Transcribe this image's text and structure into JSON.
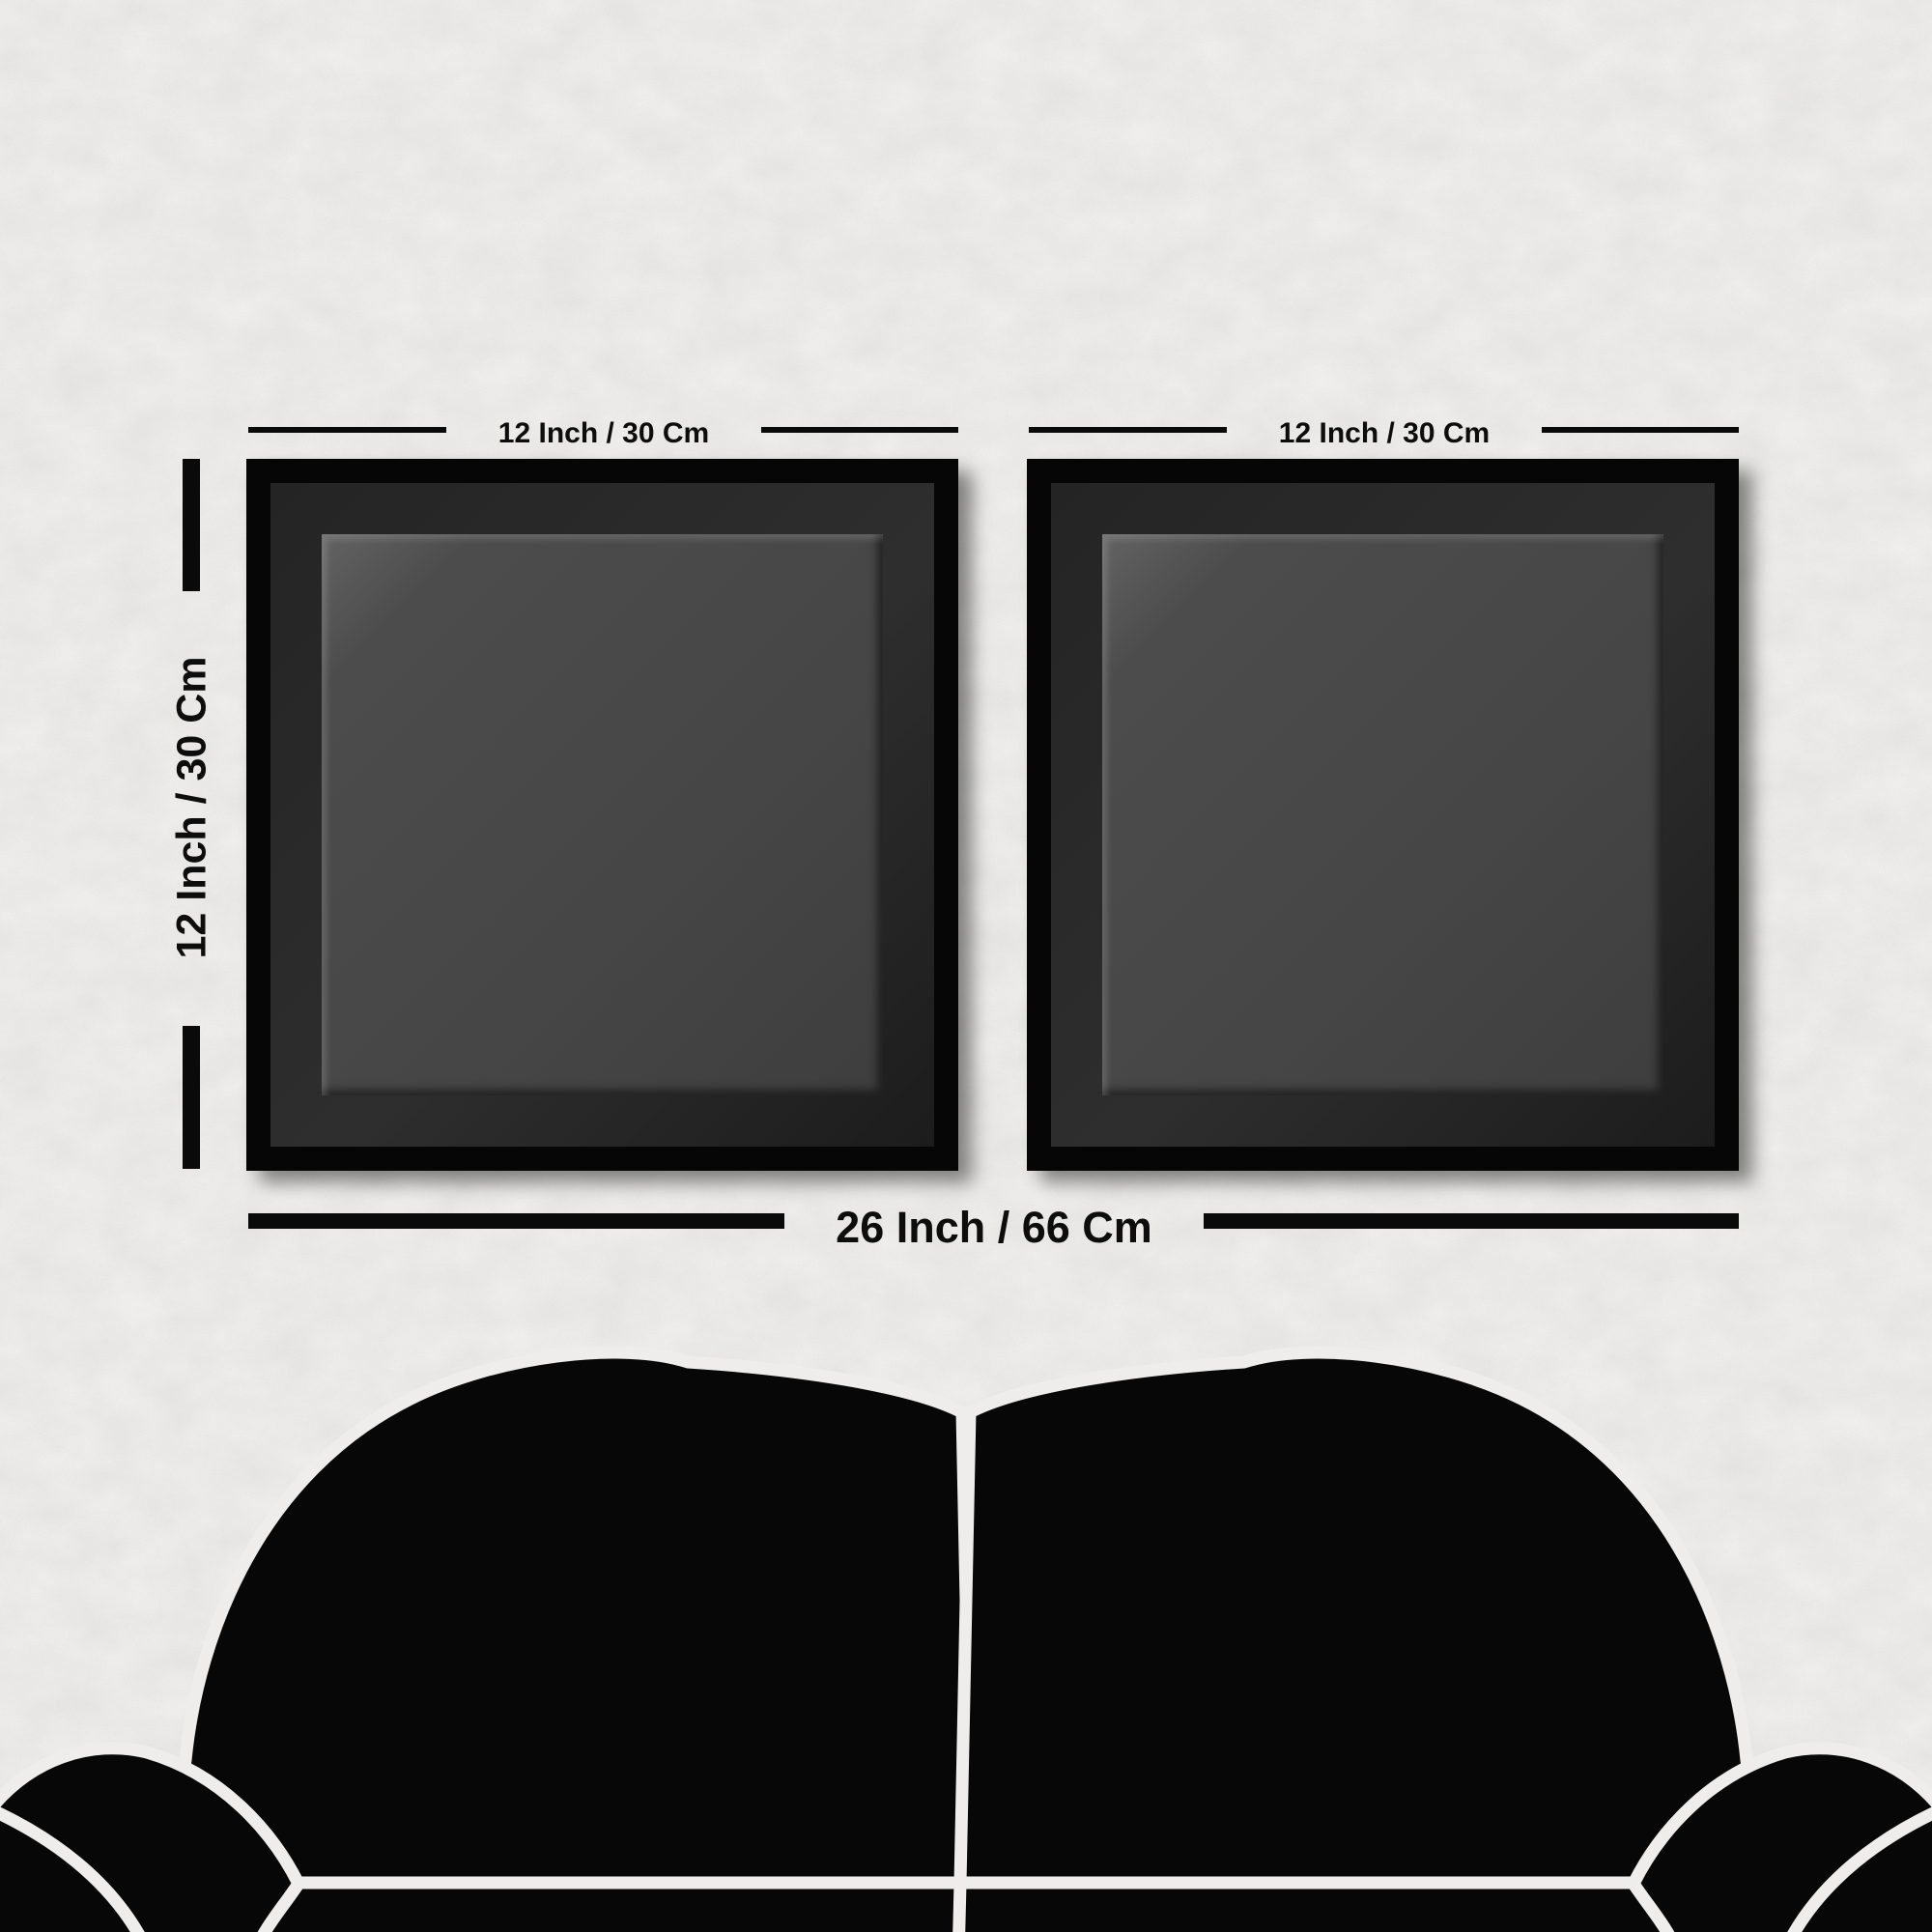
{
  "scene": {
    "description": "wall art size chart with two square frames above a sofa"
  },
  "dimensions": {
    "top_left_label": "12 Inch / 30 Cm",
    "top_right_label": "12 Inch / 30 Cm",
    "side_label": "12 Inch / 30 Cm",
    "bottom_label": "26 Inch / 66 Cm"
  },
  "colors": {
    "wall": "#f3f2f0",
    "dimension_marks": "#0a0a0a",
    "frame_border": "#060606",
    "frame_mat": "#2b2b2b",
    "canvas_gray": "#464646",
    "sofa_black": "#070708",
    "sofa_seams": "#eeedeb"
  }
}
